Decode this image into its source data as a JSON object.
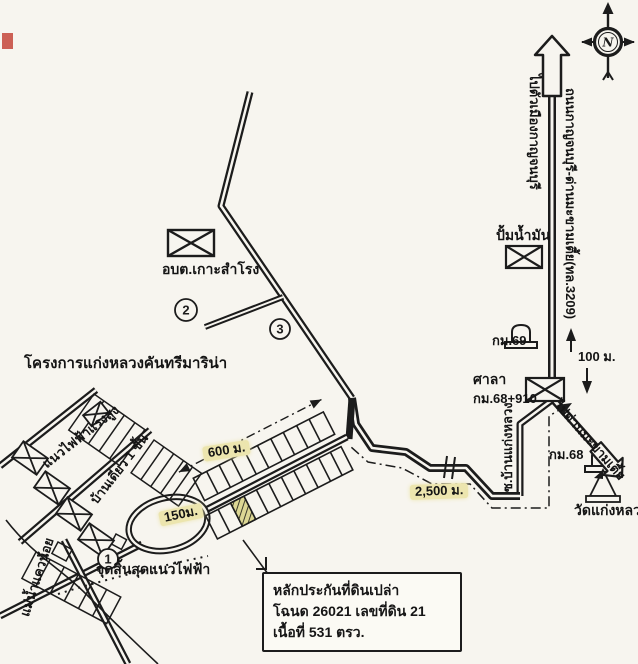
{
  "colors": {
    "paper": "#f7f5ef",
    "ink": "#1c1c1c",
    "highlight": "#ece5ae",
    "hatch_fill": "#dcd794",
    "red_mark": "#c4453a"
  },
  "compass": {
    "n": "N"
  },
  "icons": {
    "compass": "compass-rose-icon",
    "north_arrow": "north-arrow-icon",
    "building": "building-envelope-icon",
    "km_post": "kilometre-post-icon",
    "temple": "temple-chedi-icon",
    "bridge": "bridge-tick-icon",
    "river": "river-line"
  },
  "roads": {
    "to_city": "ไปตัวเมืองกาญจนบุรี",
    "highway": "ถนนกาญจนบุรี-ด่านมะขามเตี้ย(ทล.3209)",
    "to_dan": "ไปด่านมะขามเตี้ย",
    "soi": "ซ.บ้านแก่งหลวง"
  },
  "places": {
    "obt": "อบต.เกาะสำโรง",
    "gas_station": "ปั้มน้ำมัน",
    "km69": "กม.69",
    "sala": "ศาลา",
    "km68_910": "กม.68+910",
    "km68": "กม.68",
    "wat": "วัดแก่งหลวง",
    "project": "โครงการแก่งหลวงคันทรีมาริน่า",
    "power_line": "แนวไฟฟ้าแรงสูง",
    "houses": "บ้านเดี่ยว 1 ชั้น",
    "power_end": "จุดสิ้นสุดแนวไฟฟ้า",
    "river": "แม่น้ำแควน้อย"
  },
  "distances": {
    "d100": "100 ม.",
    "d600": "600 ม.",
    "d2500": "2,500 ม.",
    "d150": "150ม."
  },
  "markers": {
    "m1": "1",
    "m2": "2",
    "m3": "3"
  },
  "callout": {
    "line1": "หลักประกันที่ดินเปล่า",
    "line2": "โฉนด 26021 เลขที่ดิน 21",
    "line3": "เนื้อที่ 531 ตรว."
  }
}
